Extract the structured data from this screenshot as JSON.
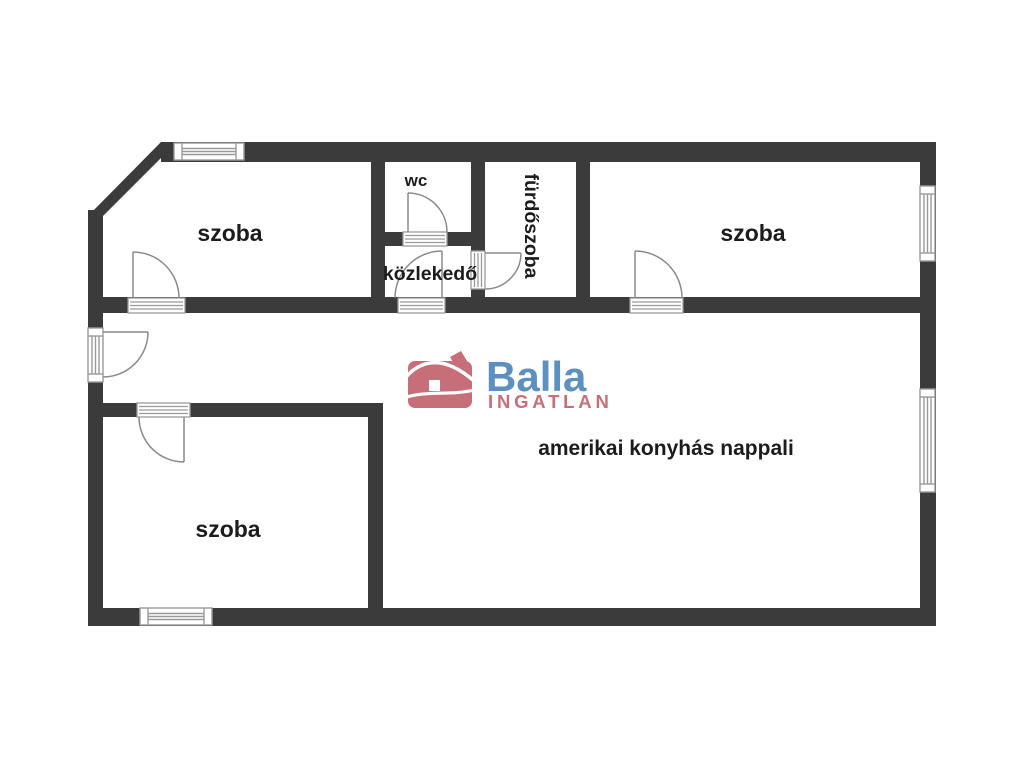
{
  "plan": {
    "colors": {
      "wall": "#3b3b3b",
      "window_frame": "#9a9a9a",
      "door": "#8a8a8a",
      "label": "#1c1c1c"
    },
    "rooms": {
      "room_top_left": "szoba",
      "wc": "wc",
      "hallway": "közlekedő",
      "bathroom": "fürdőszoba",
      "room_top_right": "szoba",
      "living_room": "amerikai konyhás nappali",
      "room_bottom_left": "szoba"
    }
  },
  "logo": {
    "brand": "Balla",
    "subtitle": "INGATLAN",
    "brand_color": "#5d8fbf",
    "accent_color": "#c66f78"
  }
}
